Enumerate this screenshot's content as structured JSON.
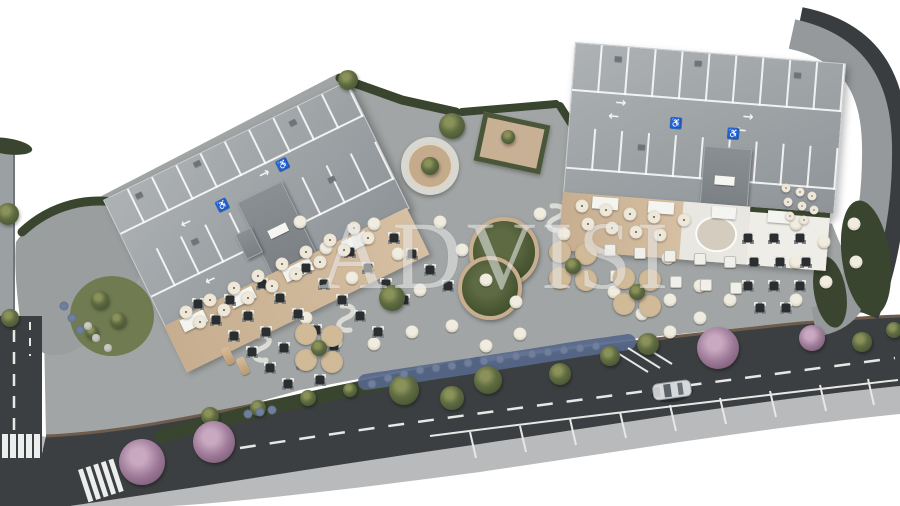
{
  "meta": {
    "description": "Aerial 3D architectural rendering of a commercial site: two buildings with rooftop parking decks, restaurant terraces, a landscaped plaza with outdoor seating, and a perimeter road with a passing car",
    "canvas_width": 900,
    "canvas_height": 506
  },
  "watermark": {
    "text": "ADVISI"
  },
  "icons": {
    "arrow_left": "←",
    "arrow_right": "→",
    "accessible": "♿"
  },
  "palette": {
    "background": "#ffffff",
    "roof_deck": "#a4a8ab",
    "roof_core": "#83888c",
    "terrace_wood": "#ccb496",
    "terrace_white": "#eceae5",
    "plaza": "#a2a5a5",
    "sidewalk": "#b8babb",
    "road": "#3c3f41",
    "curb": "#6e5c4c",
    "hedge": "#3a4530",
    "lawn": "#707b52",
    "flower_blue": "#56678a",
    "accessible_blue": "#2f66b0",
    "car_silver": "#d6d9db",
    "bench": "#dcdcd6",
    "table_cream": "#e9e4d8",
    "table_dark": "#2c2f31",
    "planter_tan": "#bfa887",
    "tree_purple": "#9a7795"
  },
  "buildings": {
    "left": {
      "label": "west building rooftop parking deck",
      "accessible_spaces": 2
    },
    "right": {
      "label": "east building rooftop parking deck",
      "accessible_spaces": 2
    }
  },
  "features": {
    "circular_deck": "circular timber deck with central tree",
    "pergola": "planted pergola deck",
    "figure_eight_bed": "figure-eight planting bed",
    "car": "silver car on perimeter road"
  },
  "scatter": [
    {
      "name": "plaza-round-table",
      "cls": "sc-cream",
      "size": 13,
      "items": [
        [
          300,
          222
        ],
        [
          326,
          248
        ],
        [
          352,
          278
        ],
        [
          374,
          224
        ],
        [
          398,
          254
        ],
        [
          420,
          290
        ],
        [
          306,
          318
        ],
        [
          336,
          342
        ],
        [
          374,
          344
        ],
        [
          412,
          332
        ],
        [
          440,
          222
        ],
        [
          462,
          250
        ],
        [
          486,
          280
        ],
        [
          516,
          302
        ],
        [
          452,
          326
        ],
        [
          486,
          346
        ],
        [
          520,
          334
        ],
        [
          540,
          214
        ],
        [
          564,
          234
        ],
        [
          590,
          254
        ],
        [
          614,
          292
        ],
        [
          642,
          314
        ],
        [
          670,
          332
        ],
        [
          670,
          300
        ],
        [
          700,
          318
        ],
        [
          700,
          286
        ],
        [
          668,
          258
        ],
        [
          730,
          300
        ],
        [
          796,
          224
        ],
        [
          824,
          242
        ],
        [
          854,
          224
        ],
        [
          796,
          262
        ],
        [
          826,
          282
        ],
        [
          856,
          262
        ],
        [
          796,
          300
        ]
      ]
    },
    {
      "name": "plaza-dark-table",
      "cls": "sc-dark",
      "size": 9,
      "items": [
        [
          198,
          304
        ],
        [
          216,
          320
        ],
        [
          234,
          336
        ],
        [
          252,
          352
        ],
        [
          270,
          368
        ],
        [
          288,
          384
        ],
        [
          230,
          300
        ],
        [
          248,
          316
        ],
        [
          266,
          332
        ],
        [
          284,
          348
        ],
        [
          302,
          364
        ],
        [
          320,
          380
        ],
        [
          262,
          284
        ],
        [
          280,
          298
        ],
        [
          298,
          314
        ],
        [
          316,
          330
        ],
        [
          334,
          346
        ],
        [
          306,
          268
        ],
        [
          324,
          284
        ],
        [
          342,
          300
        ],
        [
          360,
          316
        ],
        [
          378,
          332
        ],
        [
          350,
          252
        ],
        [
          368,
          268
        ],
        [
          386,
          284
        ],
        [
          404,
          300
        ],
        [
          394,
          238
        ],
        [
          412,
          254
        ],
        [
          430,
          270
        ],
        [
          448,
          286
        ],
        [
          748,
          238
        ],
        [
          774,
          238
        ],
        [
          800,
          238
        ],
        [
          754,
          262
        ],
        [
          780,
          262
        ],
        [
          806,
          262
        ],
        [
          748,
          286
        ],
        [
          774,
          286
        ],
        [
          800,
          286
        ],
        [
          760,
          308
        ],
        [
          786,
          308
        ]
      ]
    },
    {
      "name": "white-square-table",
      "cls": "sc-wsq",
      "size": 10,
      "items": [
        [
          610,
          250
        ],
        [
          640,
          253
        ],
        [
          670,
          256
        ],
        [
          700,
          259
        ],
        [
          730,
          262
        ],
        [
          616,
          276
        ],
        [
          646,
          279
        ],
        [
          676,
          282
        ],
        [
          706,
          285
        ],
        [
          736,
          288
        ]
      ]
    },
    {
      "name": "terrace-parasol-table",
      "cls": "sc-umb",
      "size": 13,
      "items": [
        [
          186,
          312
        ],
        [
          210,
          300
        ],
        [
          234,
          288
        ],
        [
          258,
          276
        ],
        [
          282,
          264
        ],
        [
          306,
          252
        ],
        [
          330,
          240
        ],
        [
          354,
          228
        ],
        [
          200,
          322
        ],
        [
          224,
          310
        ],
        [
          248,
          298
        ],
        [
          272,
          286
        ],
        [
          296,
          274
        ],
        [
          320,
          262
        ],
        [
          344,
          250
        ],
        [
          368,
          238
        ],
        [
          582,
          206
        ],
        [
          606,
          210
        ],
        [
          630,
          214
        ],
        [
          654,
          217
        ],
        [
          588,
          224
        ],
        [
          612,
          228
        ],
        [
          636,
          232
        ],
        [
          660,
          235
        ],
        [
          684,
          220
        ]
      ]
    },
    {
      "name": "terrace-small-table",
      "cls": "sc-umb",
      "size": 9,
      "items": [
        [
          786,
          188
        ],
        [
          800,
          192
        ],
        [
          812,
          196
        ],
        [
          788,
          202
        ],
        [
          802,
          206
        ],
        [
          814,
          210
        ],
        [
          790,
          216
        ],
        [
          804,
          220
        ]
      ]
    },
    {
      "name": "tree-planter",
      "cls": "sc-planter",
      "size": 22,
      "items": [
        [
          306,
          334
        ],
        [
          332,
          336
        ],
        [
          306,
          360
        ],
        [
          332,
          362
        ],
        [
          560,
          252
        ],
        [
          586,
          254
        ],
        [
          560,
          278
        ],
        [
          586,
          280
        ],
        [
          624,
          278
        ],
        [
          650,
          280
        ],
        [
          624,
          304
        ],
        [
          650,
          306
        ]
      ]
    },
    {
      "name": "planter-shrub",
      "cls": "sc-shrub",
      "size": 16,
      "items": [
        [
          319,
          348
        ],
        [
          573,
          266
        ],
        [
          637,
          292
        ]
      ]
    },
    {
      "name": "tree",
      "cls": "sc-tree-olive",
      "size": 22,
      "items": [
        [
          452,
          126,
          26
        ],
        [
          348,
          80,
          20
        ],
        [
          392,
          298,
          26
        ],
        [
          404,
          390,
          30
        ],
        [
          452,
          398,
          24
        ],
        [
          488,
          380,
          28
        ],
        [
          560,
          374,
          22
        ],
        [
          610,
          356,
          20
        ],
        [
          648,
          344,
          22
        ],
        [
          8,
          214,
          22
        ],
        [
          10,
          318,
          18
        ],
        [
          100,
          300,
          18
        ],
        [
          118,
          320,
          16
        ],
        [
          92,
          332,
          13
        ],
        [
          210,
          416,
          18
        ],
        [
          258,
          408,
          16
        ],
        [
          308,
          398,
          16
        ],
        [
          350,
          390,
          14
        ],
        [
          862,
          342,
          20
        ],
        [
          894,
          330,
          16
        ]
      ]
    },
    {
      "name": "flowering-tree",
      "cls": "sc-tree-purple",
      "size": 40,
      "items": [
        [
          142,
          462,
          46
        ],
        [
          214,
          442,
          42
        ],
        [
          718,
          348,
          42
        ],
        [
          812,
          338,
          26
        ]
      ]
    },
    {
      "name": "blue-flower",
      "cls": "sc-blue",
      "size": 9,
      "items": [
        [
          372,
          384
        ],
        [
          388,
          378
        ],
        [
          404,
          374
        ],
        [
          420,
          370
        ],
        [
          436,
          368
        ],
        [
          452,
          366
        ],
        [
          468,
          363
        ],
        [
          484,
          361
        ],
        [
          500,
          359
        ],
        [
          516,
          356
        ],
        [
          532,
          354
        ],
        [
          548,
          352
        ],
        [
          564,
          350
        ],
        [
          580,
          348
        ],
        [
          596,
          346
        ],
        [
          64,
          306
        ],
        [
          72,
          318
        ],
        [
          80,
          330
        ],
        [
          248,
          414
        ],
        [
          260,
          412
        ],
        [
          272,
          410
        ]
      ]
    },
    {
      "name": "rock",
      "cls": "sc-rock",
      "size": 8,
      "items": [
        [
          96,
          338
        ],
        [
          108,
          348
        ],
        [
          88,
          326
        ]
      ]
    },
    {
      "name": "sun-lounger",
      "cls": "sc-lounger",
      "w": 9,
      "h": 18,
      "rot": -25,
      "items": [
        [
          228,
          356
        ],
        [
          243,
          366
        ]
      ]
    }
  ]
}
